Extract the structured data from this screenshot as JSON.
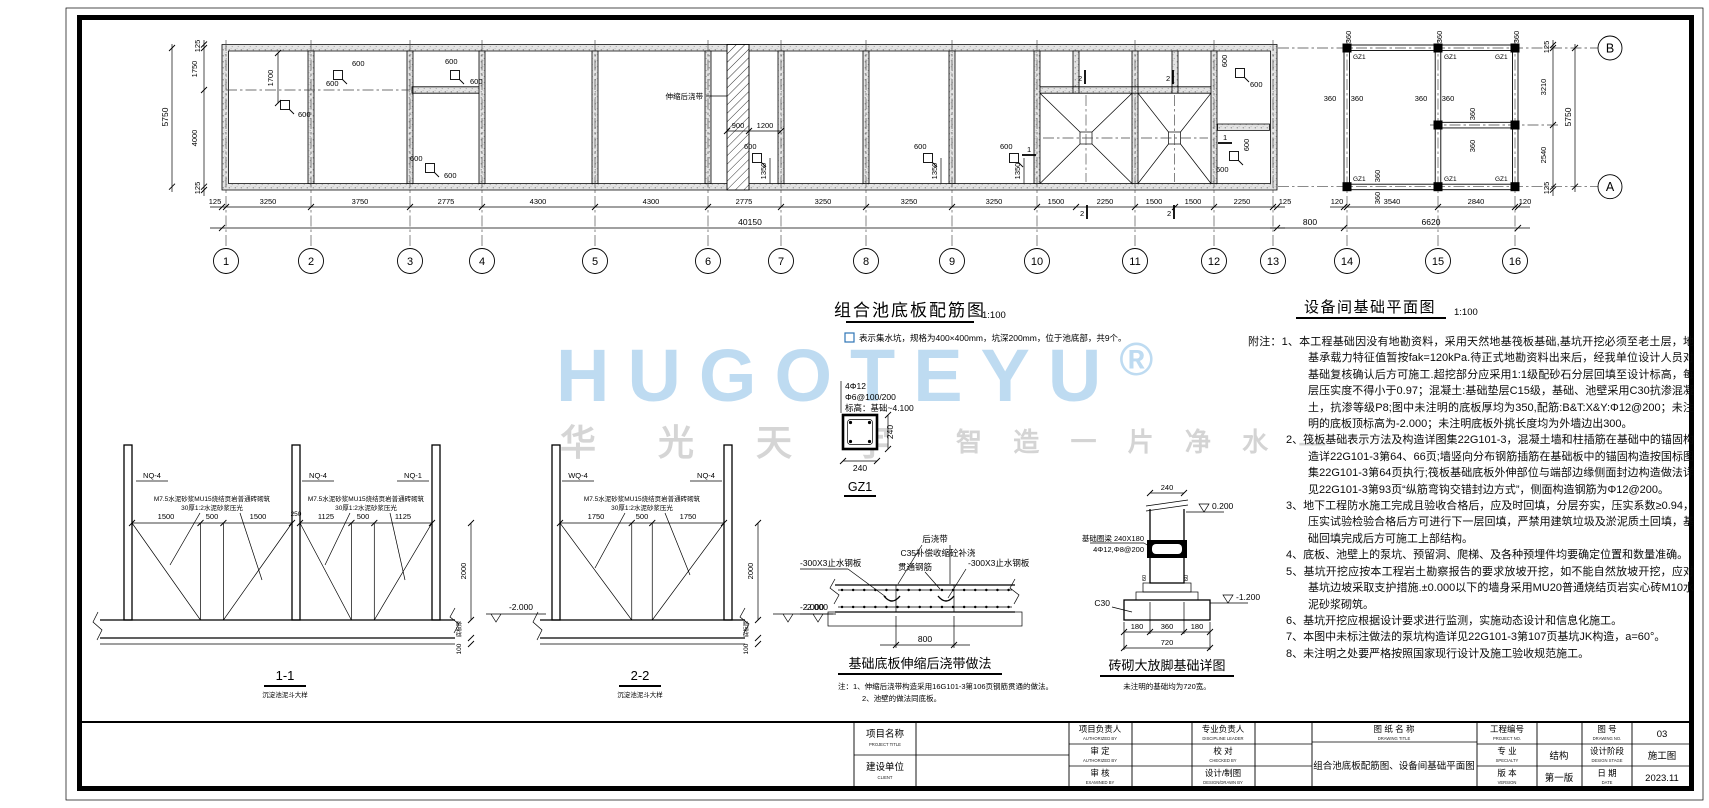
{
  "watermark": {
    "brand": "HUGOTEYU",
    "reg": "®",
    "cn_big": "华 光 天 宇",
    "cn_small": "智 造 一 片 净 水 —"
  },
  "pool_plan": {
    "title": "组合池底板配筋图",
    "scale": "1:100",
    "legend": "表示集水坑，规格为400×400mm，坑深200mm，位于池底部，共9个。",
    "band_label": "伸缩后浇带",
    "grids": [
      "1",
      "2",
      "3",
      "4",
      "5",
      "6",
      "7",
      "8",
      "9",
      "10",
      "11",
      "12",
      "13",
      "14",
      "15",
      "16"
    ],
    "dims_bottom": [
      "125",
      "3250",
      "3750",
      "2775",
      "4300",
      "4300",
      "2775",
      "3250",
      "3250",
      "3250",
      "1500",
      "2250",
      "1500",
      "1500",
      "2250",
      "125"
    ],
    "total": "40150",
    "dims_left": [
      "125",
      "1750",
      "4000",
      "125"
    ],
    "overall_left": "5750",
    "d600": "600",
    "d1350": "1350",
    "d1700": "1700",
    "d1200": "1200",
    "d900": "900",
    "mark1": "1",
    "mark2": "2"
  },
  "equip_plan": {
    "title": "设备间基础平面图",
    "scale": "1:100",
    "gz1": "GZ1",
    "d360": "360",
    "d120": "120",
    "dims_bottom": [
      "3540",
      "2840"
    ],
    "total": "6620",
    "gap": "800",
    "dims_right": [
      "125",
      "3210",
      "2540",
      "125"
    ],
    "overall_right": "5750",
    "axis_a": "A",
    "axis_b": "B"
  },
  "sections": {
    "s11_title": "1-1",
    "s22_title": "2-2",
    "subtitle": "沉淀池泥斗大样",
    "s11_walls": [
      "NQ-4",
      "NQ-4",
      "NQ-1"
    ],
    "s22_walls": [
      "WQ-4",
      "NQ-4"
    ],
    "s11_dims": [
      "1500",
      "500",
      "1500",
      "250",
      "1125",
      "500",
      "1125"
    ],
    "s22_dims": [
      "1750",
      "500",
      "1750"
    ],
    "brick_note1": "M7.5水泥砂浆MU15烧结页岩普通砖砌筑",
    "brick_note2": "30厚1:2水泥砂浆压光",
    "height": "2000",
    "level": "-2.000",
    "slab_label": "底板厚",
    "pad": "100"
  },
  "gz1_detail": {
    "bars": "4Φ12",
    "stirrups": "Φ6@100/200",
    "elev": "标高：基础~4.100",
    "dim": "240",
    "title": "GZ1"
  },
  "pour_band": {
    "label": "后浇带",
    "concrete": "C35补偿收缩砼补浇",
    "rebar": "贯通钢筋",
    "waterstop": "-300X3止水钢板",
    "level": "-2.000",
    "width": "800",
    "title": "基础底板伸缩后浇带做法",
    "note1": "注：1、伸缩后浇带构造采用16G101-3第106页钢筋贯通的做法。",
    "note2": "2、池壁的做法同底板。"
  },
  "brick_foundation": {
    "beam": "基础圈梁 240X180",
    "beam_bars": "4Φ12,Φ8@200",
    "concrete": "C30",
    "level_top": "0.200",
    "level_bottom": "-1.200",
    "dim_top": "240",
    "dims": [
      "180",
      "360",
      "180"
    ],
    "total": "720",
    "d60": "60",
    "title": "砖砌大放脚基础详图",
    "subtitle": "未注明的基础均为720宽。"
  },
  "notes": {
    "title": "附注：",
    "items": [
      "1、本工程基础因没有地勘资料，采用天然地基筏板基础,基坑开挖必须至老土层，地基承载力特征值暂按fak=120kPa.待正式地勘资料出来后，经我单位设计人员对基础复核确认后方可施工.超挖部分应采用1:1级配砂石分层回填至设计标高，每层压实度不得小于0.97；混凝土:基础垫层C15级，基础、池壁采用C30抗渗混凝土，抗渗等级P8;图中未注明的底板厚均为350,配筋:B&T:X&Y:Φ12@200；未注明的底板顶标高为-2.000；未注明底板外挑长度均为外墙边出300。",
      "2、筏板基础表示方法及构造详图集22G101-3，混凝土墙和柱插筋在基础中的锚固构造详22G101-3第64、66页;墙竖向分布钢筋插筋在基础板中的锚固构造按国标图集22G101-3第64页执行;筏板基础底板外伸部位与端部边缘侧面封边构造做法详见22G101-3第93页“纵筋弯钩交错封边方式”，侧面构造钢筋为Φ12@200。",
      "3、地下工程防水施工完成且验收合格后，应及时回填，分层夯实，压实系数≥0.94，压实试验检验合格后方可进行下一层回填，严禁用建筑垃圾及淤泥质土回填，基础回填完成后方可施工上部结构。",
      "4、底板、池壁上的泵坑、预留洞、爬梯、及各种预埋件均要确定位置和数量准确。",
      "5、基坑开挖应按本工程岩土勘察报告的要求放坡开挖，如不能自然放坡开挖，应对基坑边坡采取支护措施.±0.000以下的墙身采用MU20普通烧结页岩实心砖M10水泥砂浆砌筑。",
      "6、基坑开挖应根据设计要求进行监测，实施动态设计和信息化施工。",
      "7、本图中未标注做法的泵坑构造详见22G101-3第107页基坑JK构造，a=60°。",
      "8、未注明之处要严格按照国家现行设计及施工验收规范施工。"
    ]
  },
  "titleblock": {
    "project_label": "项目名称",
    "project_en": "PROJECT TITLE",
    "client_label": "建设单位",
    "client_en": "CLIENT",
    "pm_label": "项目负责人",
    "pm_en": "AUTHORIZED BY",
    "approve_label": "审 定",
    "approve_en": "AUTHORIZED BY",
    "examine_label": "审 核",
    "examine_en": "EXAMINED BY",
    "lead_label": "专业负责人",
    "lead_en": "DISCIPLINE LEADER",
    "check_label": "校 对",
    "check_en": "CHECKED BY",
    "design_label": "设计/制图",
    "design_en": "DESIGN/DRAWN BY",
    "dwgname_label": "图 纸 名 称",
    "dwgname_en": "DRAWING TITLE",
    "dwgname": "组合池底板配筋图、设备间基础平面图",
    "projno_label": "工程编号",
    "projno_en": "PROJECT NO.",
    "spec_label": "专 业",
    "spec_en": "SPECIALTY",
    "spec": "结构",
    "ver_label": "版 本",
    "ver_en": "VERSION",
    "ver": "第一版",
    "figno_label": "图 号",
    "figno_en": "DRAWING NO.",
    "figno": "03",
    "stage_label": "设计阶段",
    "stage_en": "DESIGN STAGE",
    "stage": "施工图",
    "date_label": "日 期",
    "date_en": "DATE",
    "date": "2023.11"
  }
}
